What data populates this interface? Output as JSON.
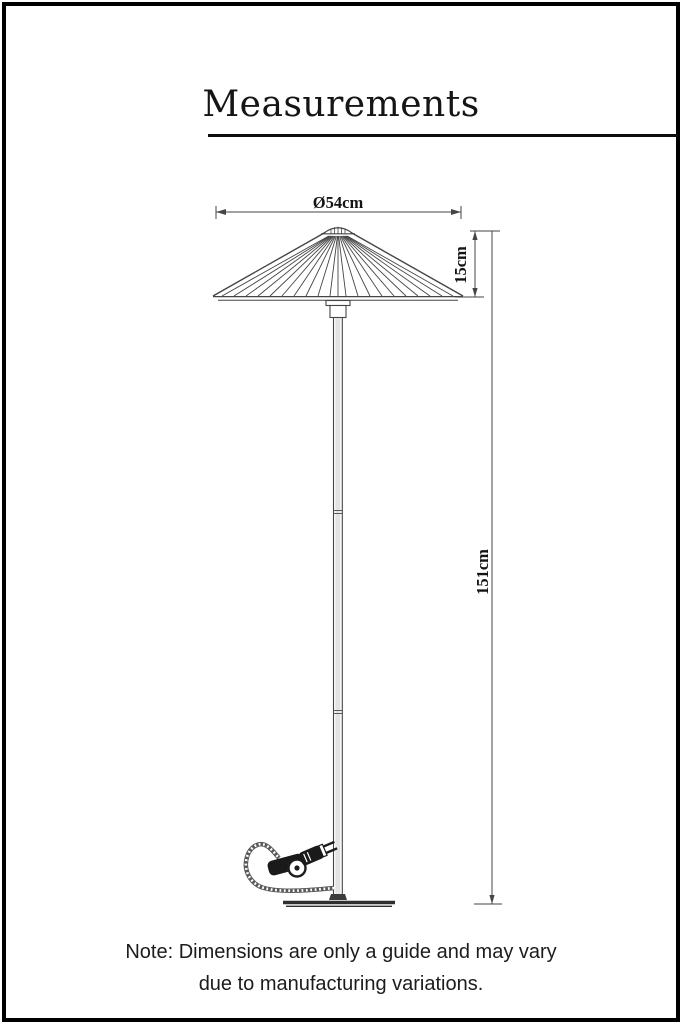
{
  "header": {
    "title": "Measurements"
  },
  "diagram": {
    "subject": "floor-lamp-technical-drawing",
    "labels": {
      "shade_diameter": "Ø54cm",
      "shade_height": "15cm",
      "total_height": "151cm"
    }
  },
  "footer": {
    "note_line1": "Note: Dimensions are only a guide and may vary",
    "note_line2": "due to manufacturing variations."
  },
  "colors": {
    "background": "#ffffff",
    "border": "#000000",
    "drawing_line": "#454545",
    "label_text": "#141414"
  }
}
